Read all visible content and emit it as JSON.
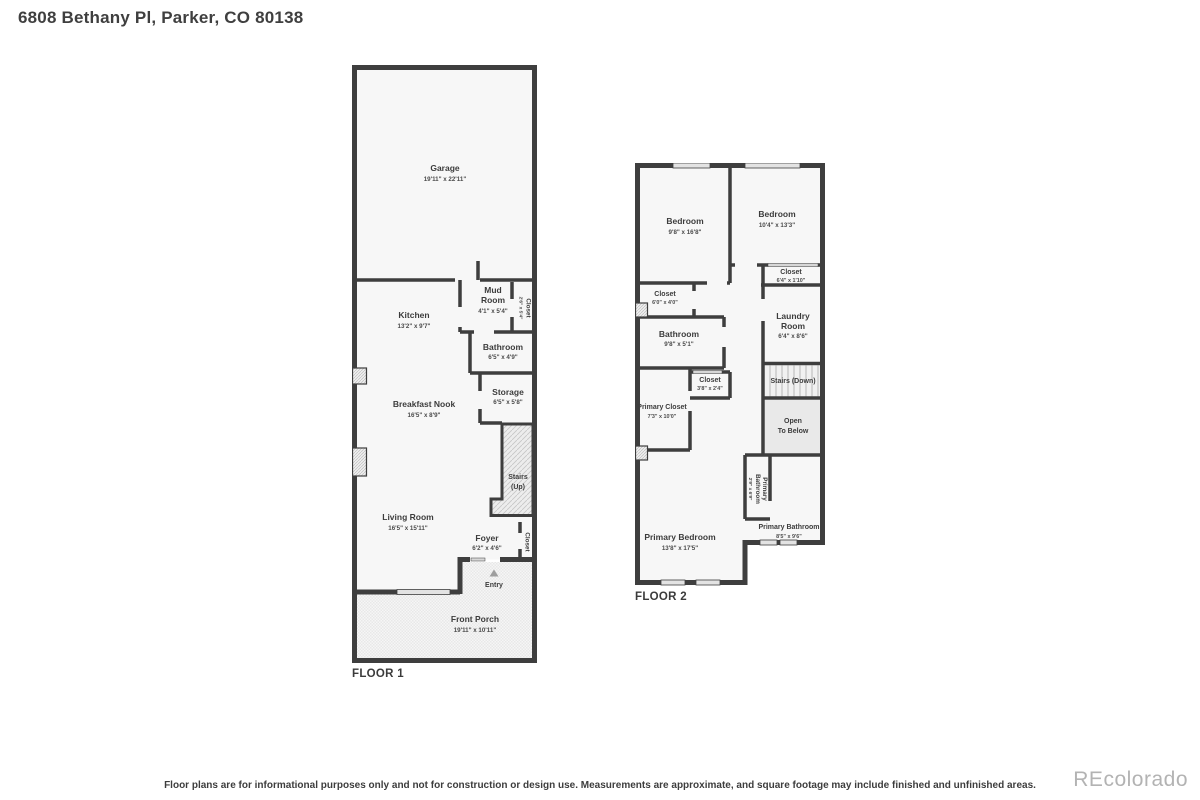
{
  "page": {
    "title": "6808 Bethany Pl, Parker, CO 80138",
    "disclaimer": "Floor plans are for informational purposes only and not for construction or design use. Measurements are approximate, and square footage may include finished and unfinished areas.",
    "watermark": "REcolorado"
  },
  "colors": {
    "wall": "#3e3e3e",
    "room_fill": "#f7f7f7",
    "stairs_fill": "#ededed",
    "open_to_below_fill": "#e9e9e9",
    "window_fill": "#e3e3e3",
    "text": "#3c3c3c",
    "watermark": "#b3b3b3"
  },
  "floor1": {
    "label": "FLOOR 1",
    "rooms": {
      "garage": {
        "name": "Garage",
        "dims": "19'11\" x 22'11\""
      },
      "kitchen": {
        "name": "Kitchen",
        "dims": "13'2\" x 9'7\""
      },
      "mud_room": {
        "name": "Mud",
        "name2": "Room",
        "dims": "4'1\" x 5'4\""
      },
      "mud_closet": {
        "name": "Closet",
        "dims": "2'6\" x 5'4\""
      },
      "bathroom": {
        "name": "Bathroom",
        "dims": "6'5\" x 4'9\""
      },
      "storage": {
        "name": "Storage",
        "dims": "6'5\" x 5'8\""
      },
      "breakfast_nook": {
        "name": "Breakfast Nook",
        "dims": "16'5\" x 8'9\""
      },
      "stairs_up": {
        "name": "Stairs",
        "name2": "(Up)"
      },
      "living_room": {
        "name": "Living Room",
        "dims": "16'5\" x 15'11\""
      },
      "foyer": {
        "name": "Foyer",
        "dims": "6'2\" x 4'6\""
      },
      "foyer_closet": {
        "name": "Closet"
      },
      "entry": {
        "name": "Entry"
      },
      "front_porch": {
        "name": "Front Porch",
        "dims": "19'11\" x 10'11\""
      }
    }
  },
  "floor2": {
    "label": "FLOOR 2",
    "rooms": {
      "bedroom_left": {
        "name": "Bedroom",
        "dims": "9'8\" x 16'8\""
      },
      "bedroom_right": {
        "name": "Bedroom",
        "dims": "10'4\" x 13'3\""
      },
      "closet_right": {
        "name": "Closet",
        "dims": "6'4\" x 1'10\""
      },
      "laundry_room": {
        "name": "Laundry",
        "name2": "Room",
        "dims": "6'4\" x 8'6\""
      },
      "closet_left": {
        "name": "Closet",
        "dims": "6'0\" x 4'0\""
      },
      "bathroom": {
        "name": "Bathroom",
        "dims": "9'8\" x 5'1\""
      },
      "closet_hall": {
        "name": "Closet",
        "dims": "3'8\" x 2'4\""
      },
      "stairs_down": {
        "name": "Stairs (Down)"
      },
      "primary_closet": {
        "name": "Primary Closet",
        "dims": "7'3\" x 10'0\""
      },
      "open_to_below": {
        "name": "Open",
        "name2": "To Below"
      },
      "primary_bath_wc": {
        "name": "Primary",
        "name2": "Bathroom",
        "dims": "2'9\" x 6'9\""
      },
      "primary_bathroom": {
        "name": "Primary Bathroom",
        "dims": "8'5\" x 9'6\""
      },
      "primary_bedroom": {
        "name": "Primary Bedroom",
        "dims": "13'8\" x 17'5\""
      }
    }
  }
}
